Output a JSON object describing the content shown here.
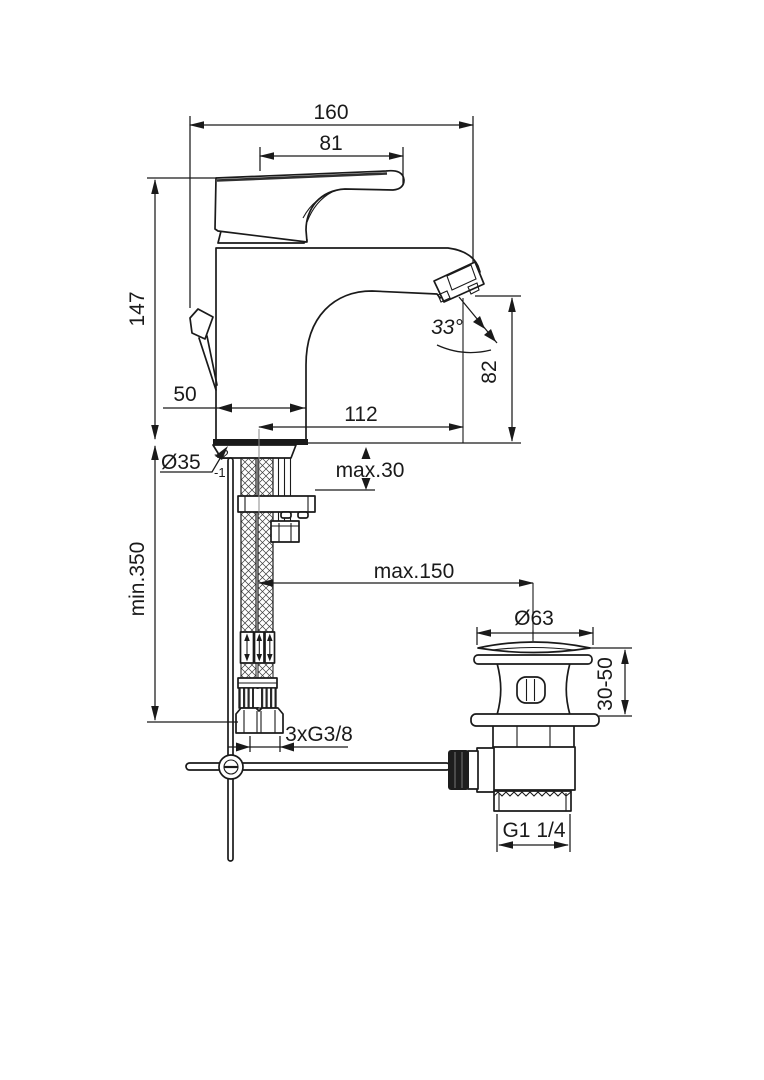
{
  "drawing": {
    "type": "technical-dimension-drawing",
    "subject": "single-lever basin mixer faucet with flexible supply hoses and pop-up waste",
    "colors": {
      "line": "#1a1a1a",
      "background": "#ffffff"
    },
    "labels": {
      "total_length": "160",
      "handle_length": "81",
      "body_height": "147",
      "body_depth": "50",
      "spout_reach": "112",
      "spray_angle": "33°",
      "spout_height": "82",
      "hole_diameter": "Ø35",
      "hole_tol_upper": "+2",
      "hole_tol_lower": "-1",
      "deck_max_thickness": "max.30",
      "hose_min_length": "min.350",
      "waste_max_distance": "max.150",
      "waste_cap_diameter": "Ø63",
      "waste_height_range": "30-50",
      "supply_thread": "3xG3/8",
      "waste_thread": "G1 1/4"
    }
  }
}
